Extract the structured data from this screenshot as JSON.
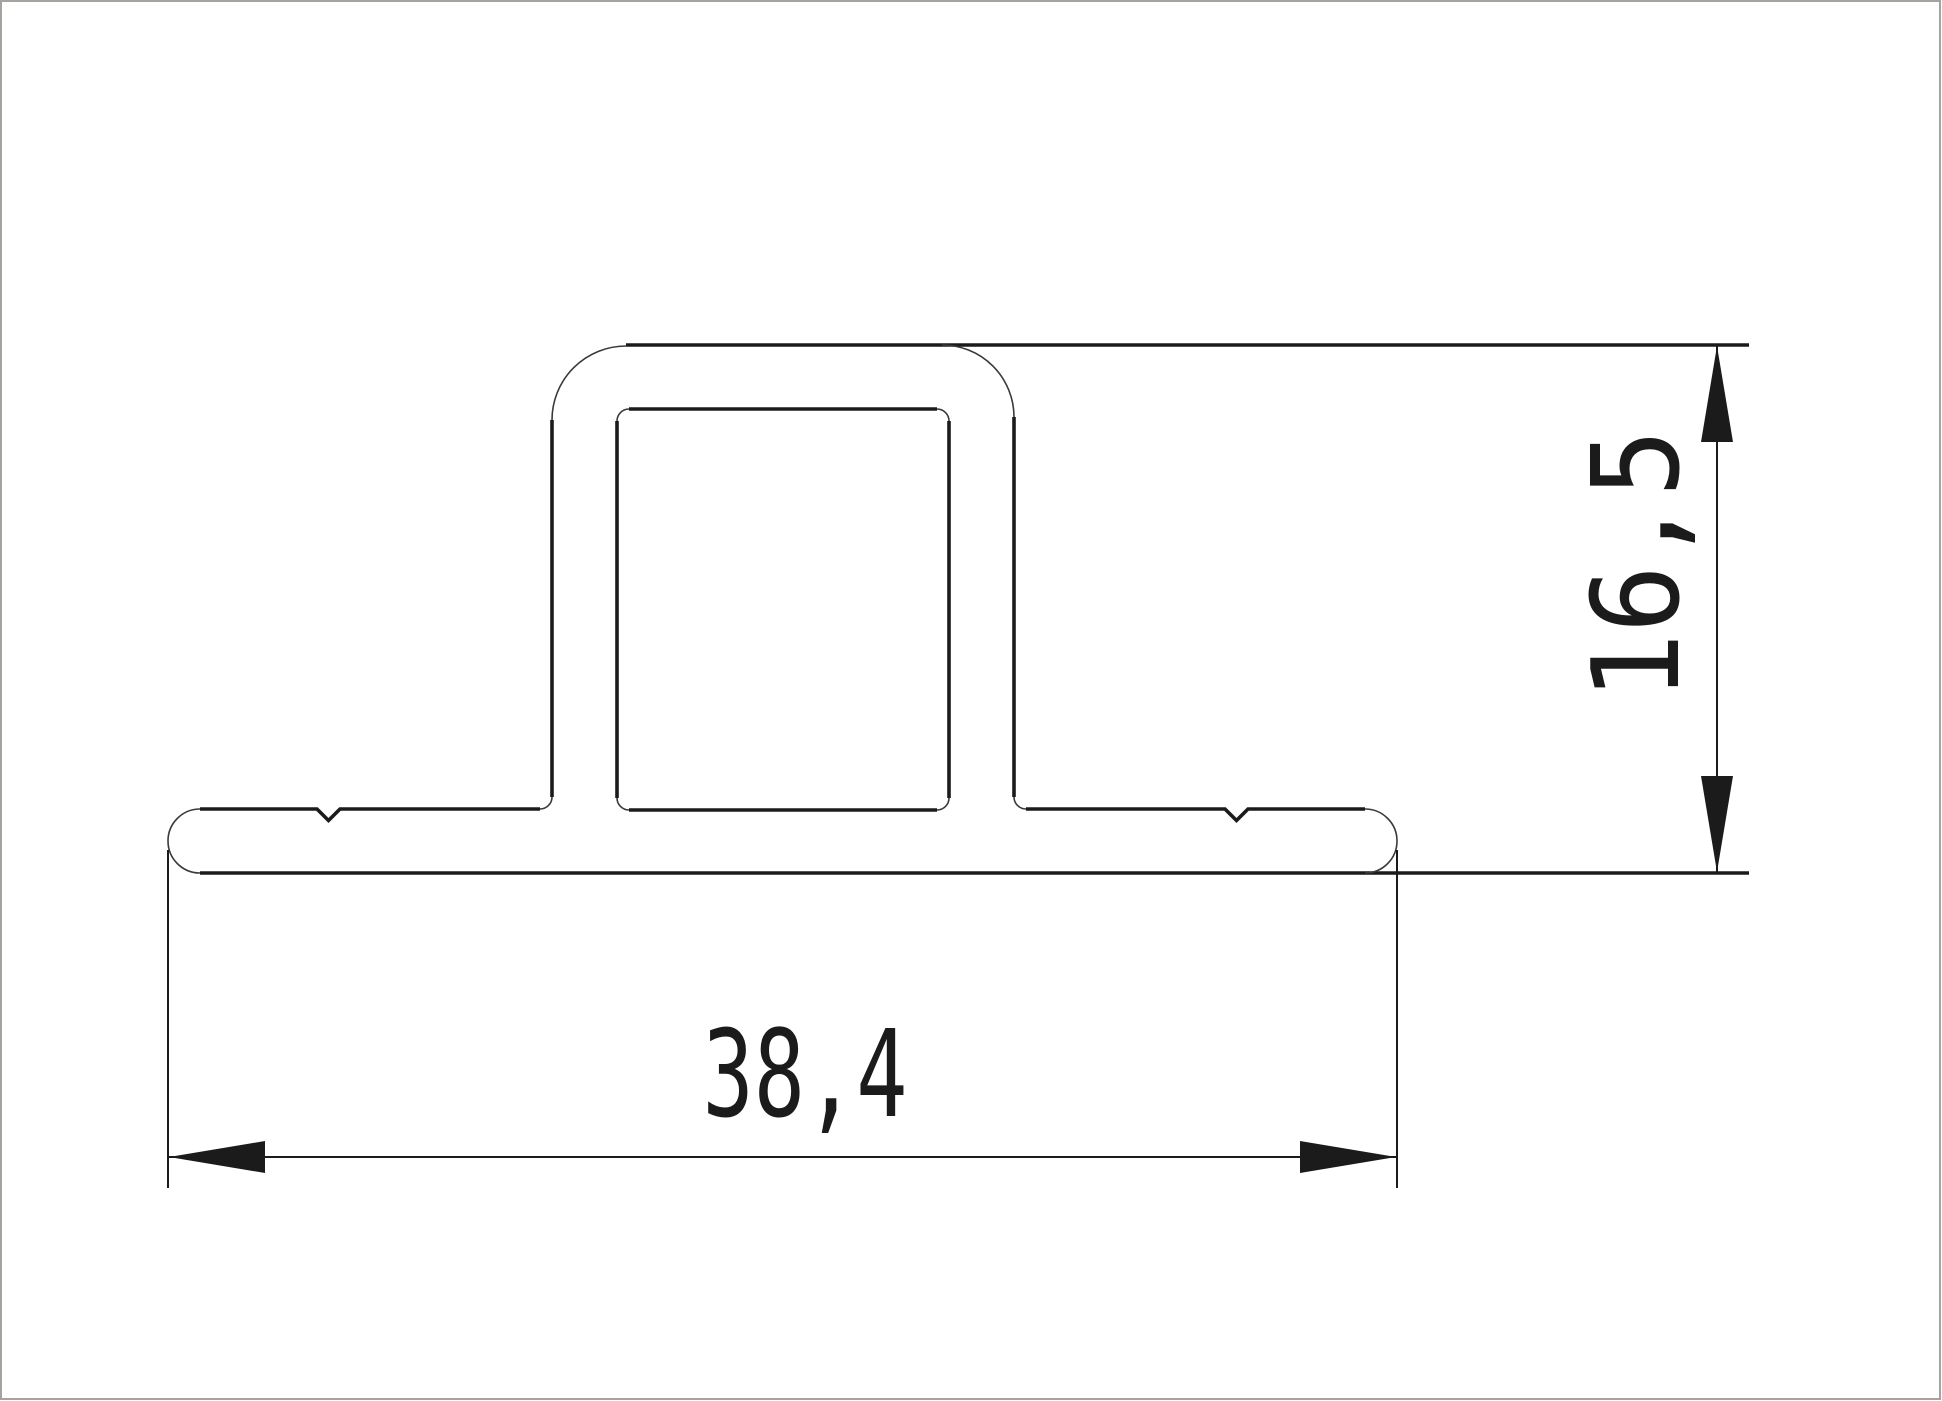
{
  "page": {
    "background": "#ffffff",
    "border_color": "#a6a29e"
  },
  "drawing": {
    "type": "profile-cross-section",
    "line_color": "#1b1b1b",
    "arc_color": "#3a3a3a",
    "dims": {
      "width_label": "38,4",
      "width_mm": 38.4,
      "height_label": "16,5",
      "height_mm": 16.5
    }
  }
}
